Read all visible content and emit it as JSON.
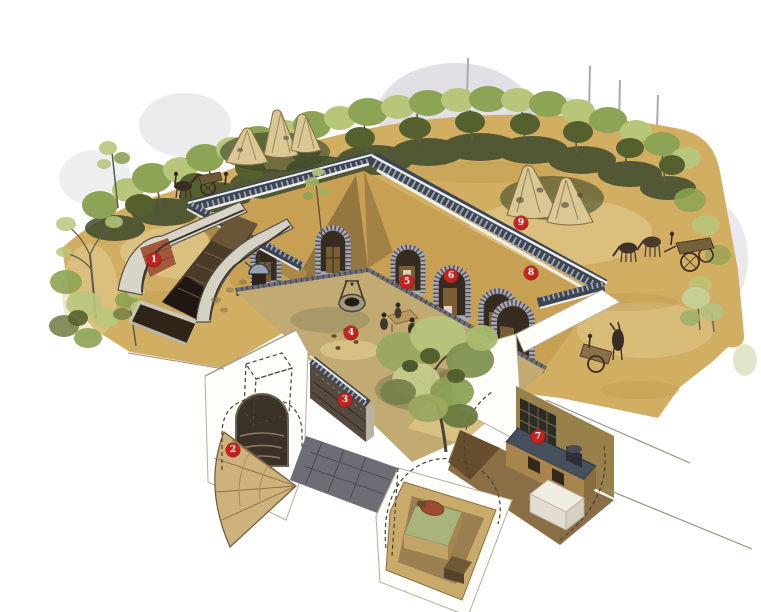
{
  "figure": {
    "kind": "watercolor architectural cutaway illustration",
    "subject": "sunken courtyard dwelling (underground courtyard house) with surface landscape, entrance ramp, courtyard arched rooms and sectioned underground chambers",
    "callout_count": 9
  },
  "markers": {
    "shape": "red numbered circle",
    "items": [
      {
        "label": "1",
        "x": 154,
        "y": 260
      },
      {
        "label": "2",
        "x": 233,
        "y": 450
      },
      {
        "label": "3",
        "x": 345,
        "y": 400
      },
      {
        "label": "4",
        "x": 351,
        "y": 333
      },
      {
        "label": "5",
        "x": 407,
        "y": 282
      },
      {
        "label": "6",
        "x": 451,
        "y": 276
      },
      {
        "label": "7",
        "x": 538,
        "y": 437
      },
      {
        "label": "8",
        "x": 531,
        "y": 273
      },
      {
        "label": "9",
        "x": 521,
        "y": 223
      }
    ]
  },
  "palette": {
    "paper": "#ffffff",
    "mist": "#c3c4cc",
    "trunk_ghost": "#a9aab4",
    "ground": "#d2ae62",
    "ground_light": "#e4cf97",
    "ground_dark": "#b99549",
    "foliage_light": "#b8c67c",
    "foliage_mid": "#8da355",
    "foliage_olive": "#76834a",
    "foliage_dark": "#55602f",
    "foliage_deep": "#3d4a2c",
    "trunk": "#5f5a4c",
    "coping_dark": "#3e4552",
    "stone_light": "#9aa2af",
    "white_edge": "#eceff1",
    "wall_tan": "#c7a053",
    "wall_shadow": "#6b5331",
    "arch_stone": "#a8a8b2",
    "door_dark": "#352b1f",
    "wood": "#7a5c35",
    "floor": "#c2ab72",
    "floor_shadow": "#8f855e",
    "paving": "#6d6d76",
    "paving_dark": "#474750",
    "well_stone": "#a09882",
    "haystack": "#d9c795",
    "haystack_shade": "#8a6f42",
    "brick_red": "#a3583c",
    "parapet_cream": "#d8d5c8",
    "kang_green": "#a9b47c",
    "blanket_red": "#9c4a30",
    "room_floor": "#8a6f46",
    "room_floor_dark": "#5c4527",
    "stove_top": "#46505c",
    "stove_front": "#a8854c",
    "lattice": "#2e2a24",
    "white_face": "#fdfdfa",
    "cut_line": "#9a9183",
    "cut_edge": "#b7ae9c",
    "dash": "#4a4238",
    "marker": "#c32420",
    "marker_rim": "#8e1a16",
    "marker_text": "#ffffff"
  }
}
